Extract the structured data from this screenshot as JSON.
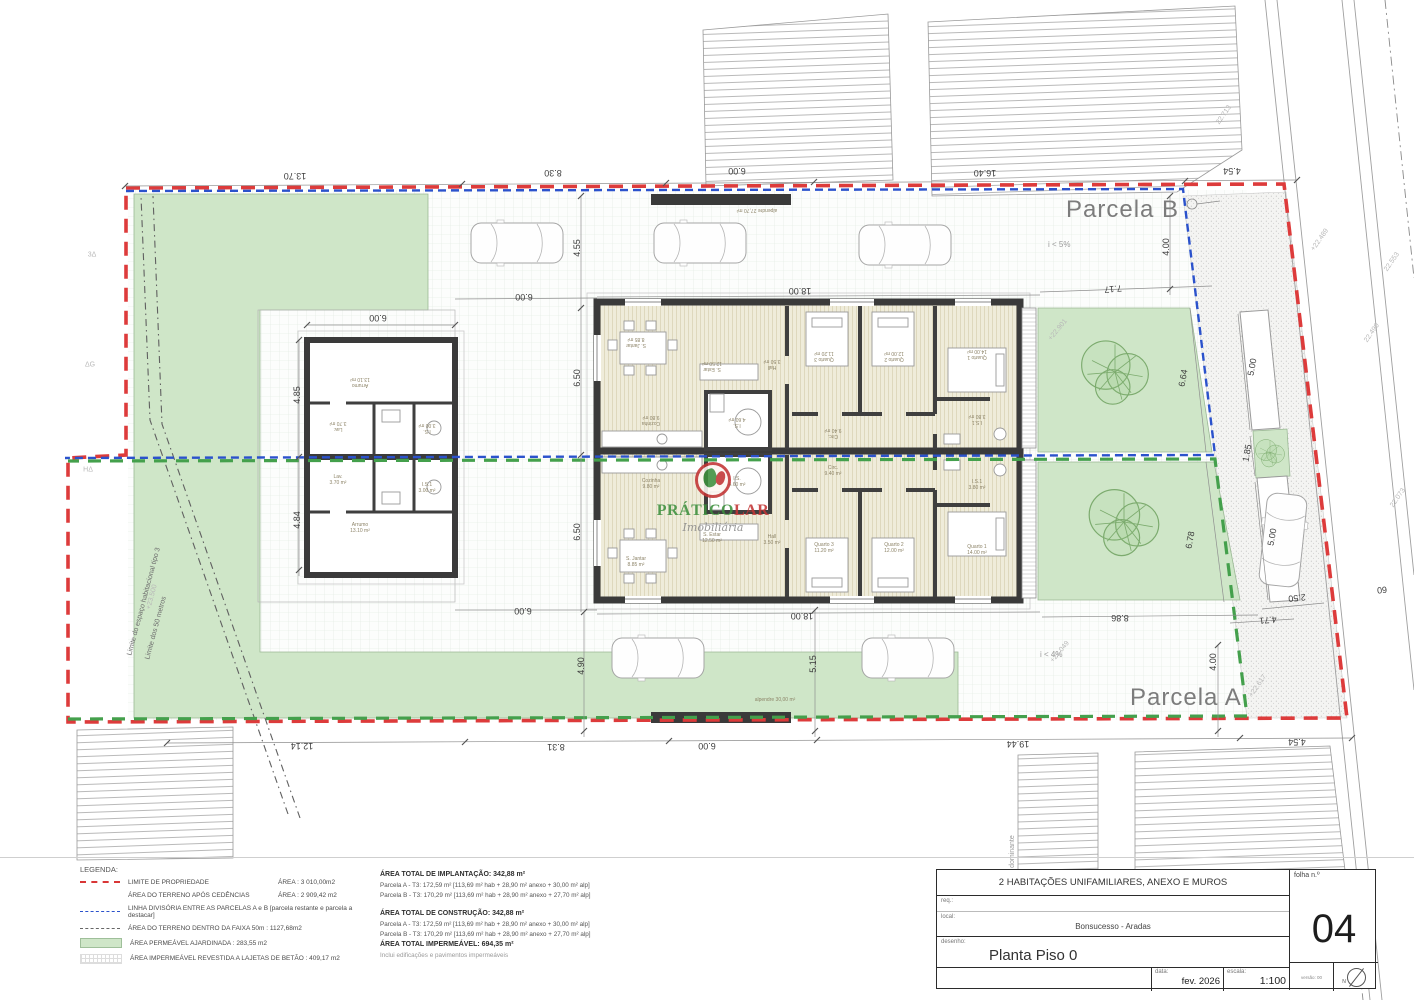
{
  "sheet": {
    "parcela_b": "Parcela B",
    "parcela_a": "Parcela A",
    "slope_b": "i < 5%",
    "slope_a": "i < 4%",
    "limit_note_1": "Limite do espaço habitacional tipo 3",
    "limit_note_2": "Limite dos 50 metros",
    "alignment_note": "alinhamento dominante"
  },
  "watermark": {
    "brand_part1": "PRÁTICO",
    "brand_part2": "LAR",
    "subtitle": "Imobiliária"
  },
  "plan": {
    "dimensions": [
      {
        "t": "13.70",
        "x": 295,
        "y": 176,
        "r": 180
      },
      {
        "t": "8.30",
        "x": 553,
        "y": 173,
        "r": 180
      },
      {
        "t": "6.00",
        "x": 737,
        "y": 171,
        "r": 180
      },
      {
        "t": "16.40",
        "x": 985,
        "y": 173,
        "r": 180
      },
      {
        "t": "4.54",
        "x": 1232,
        "y": 171,
        "r": 180
      },
      {
        "t": "4.55",
        "x": 577,
        "y": 248,
        "r": -90
      },
      {
        "t": "6.00",
        "x": 524,
        "y": 297,
        "r": 180
      },
      {
        "t": "18.00",
        "x": 800,
        "y": 291,
        "r": 180
      },
      {
        "t": "7.17",
        "x": 1113,
        "y": 289,
        "r": 175
      },
      {
        "t": "4.00",
        "x": 1166,
        "y": 247,
        "r": -90
      },
      {
        "t": "6.00",
        "x": 378,
        "y": 318,
        "r": 180
      },
      {
        "t": "4.85",
        "x": 297,
        "y": 395,
        "r": -90
      },
      {
        "t": "4.84",
        "x": 297,
        "y": 520,
        "r": -90
      },
      {
        "t": "6.50",
        "x": 577,
        "y": 378,
        "r": -90
      },
      {
        "t": "6.50",
        "x": 577,
        "y": 532,
        "r": -90
      },
      {
        "t": "6.64",
        "x": 1183,
        "y": 378,
        "r": -80
      },
      {
        "t": "6.78",
        "x": 1190,
        "y": 540,
        "r": -80
      },
      {
        "t": "8.86",
        "x": 1120,
        "y": 618,
        "r": 180
      },
      {
        "t": "4.00",
        "x": 1213,
        "y": 662,
        "r": -90
      },
      {
        "t": "5.00",
        "x": 1252,
        "y": 367,
        "r": -80
      },
      {
        "t": "1.85",
        "x": 1247,
        "y": 453,
        "r": -80
      },
      {
        "t": "5.00",
        "x": 1272,
        "y": 537,
        "r": -80
      },
      {
        "t": "2.50",
        "x": 1297,
        "y": 598,
        "r": 174
      },
      {
        "t": "4.71",
        "x": 1268,
        "y": 620,
        "r": 174
      },
      {
        "t": "60",
        "x": 1382,
        "y": 590,
        "r": 174
      },
      {
        "t": "4.90",
        "x": 581,
        "y": 666,
        "r": -90
      },
      {
        "t": "5.15",
        "x": 813,
        "y": 664,
        "r": -90
      },
      {
        "t": "6.00",
        "x": 523,
        "y": 611,
        "r": 180
      },
      {
        "t": "18.00",
        "x": 802,
        "y": 616,
        "r": 180
      },
      {
        "t": "12.14",
        "x": 302,
        "y": 746,
        "r": 180
      },
      {
        "t": "8.31",
        "x": 556,
        "y": 747,
        "r": 180
      },
      {
        "t": "6.00",
        "x": 707,
        "y": 746,
        "r": 180
      },
      {
        "t": "19.44",
        "x": 1018,
        "y": 744,
        "r": 180
      },
      {
        "t": "4.54",
        "x": 1297,
        "y": 742,
        "r": 180
      }
    ],
    "elevations": [
      {
        "t": "+22.901",
        "x": 1058,
        "y": 330,
        "r": -50
      },
      {
        "t": "+23.049",
        "x": 1060,
        "y": 652,
        "r": -50
      },
      {
        "t": "22.713",
        "x": 1224,
        "y": 115,
        "r": -55
      },
      {
        "t": "+22.489",
        "x": 1320,
        "y": 240,
        "r": -55
      },
      {
        "t": "22.490",
        "x": 1372,
        "y": 333,
        "r": -55
      },
      {
        "t": "22.553",
        "x": 1392,
        "y": 262,
        "r": -55
      },
      {
        "t": "22.073",
        "x": 1398,
        "y": 498,
        "r": -55
      },
      {
        "t": "+23.500",
        "x": 152,
        "y": 597,
        "r": -75
      },
      {
        "t": "+22.617",
        "x": 1258,
        "y": 686,
        "r": -55
      },
      {
        "t": "3Δ",
        "x": 92,
        "y": 255,
        "r": 0
      },
      {
        "t": "ΔG",
        "x": 90,
        "y": 365,
        "r": 0
      },
      {
        "t": "HΔ",
        "x": 88,
        "y": 470,
        "r": 0
      }
    ],
    "rooms": [
      {
        "t": "Cozinha\n9.80 m²",
        "x": 651,
        "y": 484,
        "r": 0
      },
      {
        "t": "I.S.\n4.60 m²",
        "x": 737,
        "y": 482,
        "r": 0
      },
      {
        "t": "S. Estar\n12.50 m²",
        "x": 712,
        "y": 538,
        "r": 0
      },
      {
        "t": "S. Jantar\n8.85 m²",
        "x": 636,
        "y": 562,
        "r": 0
      },
      {
        "t": "Hall\n3.50 m²",
        "x": 772,
        "y": 540,
        "r": 0
      },
      {
        "t": "Circ.\n9.40 m²",
        "x": 833,
        "y": 471,
        "r": 0
      },
      {
        "t": "Quarto 3\n11.20 m²",
        "x": 824,
        "y": 548,
        "r": 0
      },
      {
        "t": "Quarto 2\n12.00 m²",
        "x": 894,
        "y": 548,
        "r": 0
      },
      {
        "t": "I.S.1\n3.80 m²",
        "x": 977,
        "y": 485,
        "r": 0
      },
      {
        "t": "Quarto 1\n14.00 m²",
        "x": 977,
        "y": 550,
        "r": 0
      },
      {
        "t": "Cozinha\n9.80 m²",
        "x": 651,
        "y": 420,
        "r": 180
      },
      {
        "t": "I.S.\n4.60 m²",
        "x": 737,
        "y": 422,
        "r": 180
      },
      {
        "t": "S. Estar\n12.50 m²",
        "x": 712,
        "y": 366,
        "r": 180
      },
      {
        "t": "S. Jantar\n8.85 m²",
        "x": 636,
        "y": 342,
        "r": 180
      },
      {
        "t": "Hall\n3.50 m²",
        "x": 772,
        "y": 364,
        "r": 180
      },
      {
        "t": "Circ.\n9.40 m²",
        "x": 833,
        "y": 433,
        "r": 180
      },
      {
        "t": "Quarto 3\n11.20 m²",
        "x": 824,
        "y": 356,
        "r": 180
      },
      {
        "t": "Quarto 2\n12.00 m²",
        "x": 894,
        "y": 356,
        "r": 180
      },
      {
        "t": "I.S.1\n3.80 m²",
        "x": 977,
        "y": 419,
        "r": 180
      },
      {
        "t": "Quarto 1\n14.00 m²",
        "x": 977,
        "y": 354,
        "r": 180
      },
      {
        "t": "Arrumo\n13.10 m²",
        "x": 360,
        "y": 382,
        "r": 180
      },
      {
        "t": "Lav.\n3.70 m²",
        "x": 338,
        "y": 426,
        "r": 180
      },
      {
        "t": "I.S.\n3.00 m²",
        "x": 427,
        "y": 428,
        "r": 180
      },
      {
        "t": "Lav.\n3.70 m²",
        "x": 338,
        "y": 480,
        "r": 0
      },
      {
        "t": "I.S.1\n3.00 m²",
        "x": 427,
        "y": 488,
        "r": 0
      },
      {
        "t": "Arrumo\n13.10 m²",
        "x": 360,
        "y": 528,
        "r": 0
      },
      {
        "t": "alpendre 27,70 m²",
        "x": 757,
        "y": 210,
        "r": 180
      },
      {
        "t": "alpendre 30,00 m²",
        "x": 775,
        "y": 700,
        "r": 0
      }
    ]
  },
  "legend": {
    "title": "LEGENDA:",
    "rows": [
      {
        "label": "LIMITE DE PROPRIEDADE",
        "value": "ÁREA : 3 010,00m2"
      },
      {
        "label": "ÁREA DO TERRENO APÓS CEDÊNCIAS",
        "value": "ÁREA : 2 909,42 m2"
      },
      {
        "label": "LINHA DIVISÓRIA ENTRE AS PARCELAS A e B [parcela restante e parcela a destacar]",
        "value": ""
      },
      {
        "label": "ÁREA DO TERRENO DENTRO DA FAIXA 50m : 1127,68m2",
        "value": ""
      },
      {
        "label": "ÁREA PERMEÁVEL AJARDINADA : 283,55 m2",
        "value": ""
      },
      {
        "label": "ÁREA IMPERMEÁVEL REVESTIDA A LAJETAS DE BETÃO : 409,17 m2",
        "value": ""
      }
    ]
  },
  "areas": {
    "implantacao_title": "ÁREA TOTAL DE IMPLANTAÇÃO: 342,88 m²",
    "implantacao_a": "Parcela A - T3: 172,59 m²  [113,69 m² hab + 28,90 m² anexo + 30,00 m² alp]",
    "implantacao_b": "Parcela B - T3: 170,29 m²  [113,69 m² hab + 28,90 m² anexo + 27,70 m² alp]",
    "construcao_title": "ÁREA TOTAL DE CONSTRUÇÃO: 342,88 m²",
    "construcao_a": "Parcela A - T3: 172,59 m²  [113,69 m² hab + 28,90 m² anexo + 30,00 m² alp]",
    "construcao_b": "Parcela B - T3: 170,29 m²  [113,69 m² hab + 28,90 m² anexo + 27,70 m² alp]",
    "impermeavel_title": "ÁREA TOTAL IMPERMEÁVEL: 694,35 m²",
    "impermeavel_note": "Inclui edificações e pavimentos impermeáveis"
  },
  "titleblock": {
    "project": "2 HABITAÇÕES UNIFAMILIARES, ANEXO E MUROS",
    "req_label": "req.:",
    "local_label": "local:",
    "local_value": "Bonsucesso - Aradas",
    "desenho_label": "desenho:",
    "desenho_value": "Planta Piso 0",
    "data_label": "data:",
    "data_value": "fev. 2026",
    "escala_label": "escala:",
    "escala_value": "1:100",
    "folha_label": "folha n.º",
    "folha_value": "04",
    "versao": "versão: 00",
    "north": "N"
  }
}
